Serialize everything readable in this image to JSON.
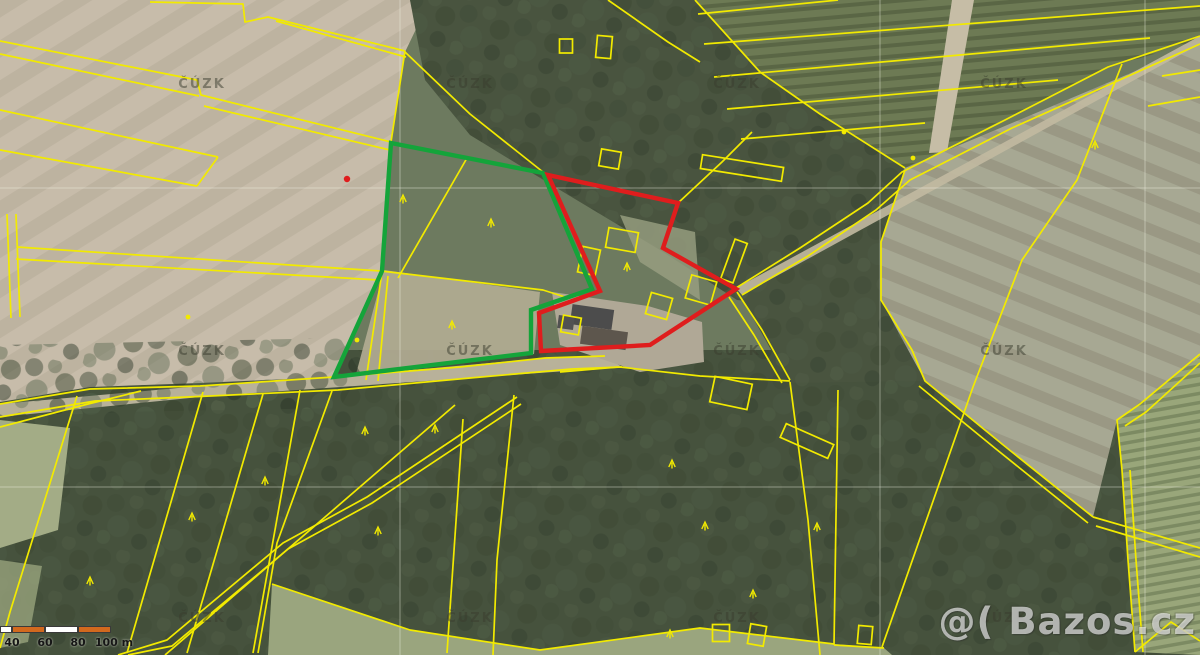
{
  "map": {
    "colors": {
      "parcel_line": "#f2ea00",
      "highlight_green": "#14a43a",
      "highlight_red": "#df1d1d",
      "scale_orange": "#d2691e",
      "scale_white": "#ffffff",
      "grid_line": "rgba(242,242,230,0.42)",
      "watermark_gray": "rgba(58,60,46,0.5)"
    },
    "attribution_watermark": {
      "text": "ČÚZK",
      "positions": [
        [
          202,
          88
        ],
        [
          470,
          88
        ],
        [
          737,
          88
        ],
        [
          1004,
          88
        ],
        [
          202,
          355
        ],
        [
          470,
          355
        ],
        [
          737,
          355
        ],
        [
          1004,
          355
        ],
        [
          202,
          622
        ],
        [
          470,
          622
        ],
        [
          737,
          622
        ],
        [
          1004,
          622
        ]
      ]
    },
    "brand_watermark": {
      "text": "@( Bazos.cz"
    },
    "scale_bar": {
      "unit": "m",
      "segments": [
        {
          "x": 0,
          "w": 12,
          "color": "white"
        },
        {
          "x": 12,
          "w": 33,
          "color": "orange"
        },
        {
          "x": 45,
          "w": 33,
          "color": "white"
        },
        {
          "x": 78,
          "w": 33,
          "color": "orange"
        }
      ],
      "labels": [
        {
          "text": "40",
          "x": 12
        },
        {
          "text": "60",
          "x": 45
        },
        {
          "text": "80",
          "x": 78
        },
        {
          "text": "100 m",
          "x": 114
        }
      ]
    },
    "highlight_green": {
      "points": [
        [
          391,
          143
        ],
        [
          543,
          173
        ],
        [
          592,
          289
        ],
        [
          531,
          310
        ],
        [
          531,
          353
        ],
        [
          334,
          377
        ],
        [
          382,
          271
        ]
      ]
    },
    "highlight_red": {
      "points": [
        [
          548,
          175
        ],
        [
          678,
          203
        ],
        [
          663,
          248
        ],
        [
          736,
          289
        ],
        [
          650,
          345
        ],
        [
          541,
          351
        ],
        [
          539,
          313
        ],
        [
          600,
          291
        ]
      ]
    },
    "red_dot": [
      347,
      179
    ],
    "grid": {
      "vertical_x": [
        400,
        880,
        1145
      ],
      "horizontal_y": [
        188,
        487
      ]
    },
    "parcel_lines": [
      [
        [
          150,
          2
        ],
        [
          243,
          4
        ],
        [
          245,
          22
        ],
        [
          268,
          17
        ],
        [
          405,
          51
        ]
      ],
      [
        [
          276,
          21
        ],
        [
          406,
          57
        ]
      ],
      [
        [
          405,
          51
        ],
        [
          391,
          142
        ]
      ],
      [
        [
          0,
          41
        ],
        [
          197,
          80
        ],
        [
          201,
          95
        ],
        [
          391,
          142
        ]
      ],
      [
        [
          0,
          54
        ],
        [
          199,
          96
        ]
      ],
      [
        [
          204,
          106
        ],
        [
          390,
          150
        ]
      ],
      [
        [
          0,
          110
        ],
        [
          218,
          157
        ]
      ],
      [
        [
          0,
          150
        ],
        [
          197,
          186
        ]
      ],
      [
        [
          218,
          157
        ],
        [
          197,
          186
        ]
      ],
      [
        [
          7,
          214
        ],
        [
          11,
          318
        ]
      ],
      [
        [
          16,
          214
        ],
        [
          20,
          317
        ]
      ],
      [
        [
          17,
          247
        ],
        [
          381,
          271
        ]
      ],
      [
        [
          16,
          259
        ],
        [
          379,
          280
        ]
      ],
      [
        [
          381,
          271
        ],
        [
          543,
          290
        ],
        [
          565,
          297
        ]
      ],
      [
        [
          382,
          272
        ],
        [
          366,
          380
        ]
      ],
      [
        [
          388,
          276
        ],
        [
          378,
          381
        ]
      ],
      [
        [
          0,
          404
        ],
        [
          90,
          389
        ],
        [
          200,
          386
        ],
        [
          334,
          377
        ],
        [
          460,
          367
        ],
        [
          545,
          358
        ],
        [
          605,
          356
        ]
      ],
      [
        [
          0,
          417
        ],
        [
          95,
          401
        ],
        [
          210,
          396
        ],
        [
          338,
          390
        ],
        [
          470,
          378
        ],
        [
          572,
          369
        ],
        [
          622,
          367
        ]
      ],
      [
        [
          0,
          427
        ],
        [
          88,
          404
        ],
        [
          141,
          391
        ]
      ],
      [
        [
          405,
          52
        ],
        [
          470,
          114
        ],
        [
          543,
          172
        ]
      ],
      [
        [
          467,
          158
        ],
        [
          398,
          278
        ]
      ],
      [
        [
          608,
          0
        ],
        [
          668,
          42
        ],
        [
          700,
          62
        ]
      ],
      [
        [
          695,
          0
        ],
        [
          760,
          72
        ],
        [
          820,
          114
        ],
        [
          905,
          168
        ]
      ],
      [
        [
          678,
          203
        ],
        [
          722,
          162
        ],
        [
          752,
          132
        ]
      ],
      [
        [
          663,
          248
        ],
        [
          736,
          289
        ]
      ],
      [
        [
          736,
          288
        ],
        [
          800,
          248
        ],
        [
          868,
          203
        ],
        [
          902,
          172
        ],
        [
          1005,
          120
        ],
        [
          1108,
          67
        ],
        [
          1200,
          36
        ]
      ],
      [
        [
          742,
          295
        ],
        [
          808,
          256
        ],
        [
          876,
          210
        ],
        [
          910,
          180
        ],
        [
          1012,
          128
        ],
        [
          1200,
          44
        ]
      ],
      [
        [
          905,
          170
        ],
        [
          881,
          242
        ],
        [
          881,
          300
        ],
        [
          912,
          350
        ],
        [
          925,
          381
        ],
        [
          1002,
          444
        ],
        [
          1093,
          517
        ]
      ],
      [
        [
          919,
          386
        ],
        [
          996,
          449
        ],
        [
          1088,
          523
        ]
      ],
      [
        [
          1093,
          517
        ],
        [
          1200,
          548
        ]
      ],
      [
        [
          1096,
          526
        ],
        [
          1200,
          557
        ]
      ],
      [
        [
          1122,
          64
        ],
        [
          1077,
          180
        ],
        [
          1022,
          260
        ],
        [
          973,
          387
        ],
        [
          882,
          647
        ]
      ],
      [
        [
          1200,
          354
        ],
        [
          1140,
          404
        ],
        [
          1117,
          420
        ],
        [
          1122,
          470
        ],
        [
          1128,
          560
        ],
        [
          1135,
          652
        ]
      ],
      [
        [
          1200,
          363
        ],
        [
          1146,
          412
        ],
        [
          1125,
          426
        ]
      ],
      [
        [
          1130,
          470
        ],
        [
          1136,
          560
        ],
        [
          1143,
          652
        ]
      ],
      [
        [
          1135,
          652
        ],
        [
          1171,
          622
        ],
        [
          1200,
          641
        ]
      ],
      [
        [
          698,
          14
        ],
        [
          838,
          0
        ]
      ],
      [
        [
          704,
          44
        ],
        [
          1200,
          6
        ]
      ],
      [
        [
          714,
          77
        ],
        [
          1150,
          38
        ]
      ],
      [
        [
          727,
          109
        ],
        [
          1058,
          80
        ]
      ],
      [
        [
          741,
          139
        ],
        [
          925,
          123
        ]
      ],
      [
        [
          1162,
          76
        ],
        [
          1200,
          70
        ]
      ],
      [
        [
          1148,
          106
        ],
        [
          1200,
          97
        ]
      ],
      [
        [
          77,
          396
        ],
        [
          10,
          612
        ],
        [
          0,
          648
        ]
      ],
      [
        [
          203,
          392
        ],
        [
          127,
          653
        ]
      ],
      [
        [
          263,
          394
        ],
        [
          187,
          653
        ]
      ],
      [
        [
          300,
          390
        ],
        [
          253,
          653
        ]
      ],
      [
        [
          332,
          391
        ],
        [
          277,
          543
        ],
        [
          258,
          653
        ]
      ],
      [
        [
          517,
          397
        ],
        [
          367,
          497
        ],
        [
          283,
          543
        ],
        [
          167,
          640
        ],
        [
          118,
          655
        ]
      ],
      [
        [
          521,
          404
        ],
        [
          372,
          503
        ],
        [
          288,
          549
        ],
        [
          172,
          646
        ],
        [
          128,
          655
        ]
      ],
      [
        [
          455,
          405
        ],
        [
          165,
          655
        ]
      ],
      [
        [
          463,
          419
        ],
        [
          447,
          653
        ]
      ],
      [
        [
          514,
          395
        ],
        [
          497,
          560
        ],
        [
          493,
          655
        ]
      ],
      [
        [
          272,
          584
        ],
        [
          410,
          630
        ],
        [
          540,
          650
        ],
        [
          700,
          628
        ],
        [
          834,
          644
        ]
      ],
      [
        [
          790,
          382
        ],
        [
          808,
          520
        ],
        [
          820,
          655
        ]
      ],
      [
        [
          838,
          390
        ],
        [
          834,
          645
        ]
      ],
      [
        [
          834,
          645
        ],
        [
          884,
          648
        ]
      ],
      [
        [
          737,
          292
        ],
        [
          762,
          330
        ],
        [
          790,
          380
        ]
      ],
      [
        [
          729,
          297
        ],
        [
          754,
          335
        ],
        [
          782,
          383
        ]
      ],
      [
        [
          620,
          367
        ],
        [
          700,
          376
        ],
        [
          790,
          381
        ]
      ],
      [
        [
          560,
          372
        ],
        [
          618,
          367
        ]
      ]
    ],
    "parcel_rects": [
      {
        "cx": 622,
        "cy": 240,
        "w": 30,
        "h": 20,
        "r": 10
      },
      {
        "cx": 589,
        "cy": 261,
        "w": 18,
        "h": 26,
        "r": 12
      },
      {
        "cx": 701,
        "cy": 290,
        "w": 26,
        "h": 24,
        "r": 16
      },
      {
        "cx": 659,
        "cy": 306,
        "w": 22,
        "h": 22,
        "r": 16
      },
      {
        "cx": 734,
        "cy": 261,
        "w": 13,
        "h": 42,
        "r": 20
      },
      {
        "cx": 571,
        "cy": 325,
        "w": 18,
        "h": 17,
        "r": 10
      },
      {
        "cx": 742,
        "cy": 168,
        "w": 82,
        "h": 14,
        "r": 9
      },
      {
        "cx": 610,
        "cy": 159,
        "w": 20,
        "h": 17,
        "r": 10
      },
      {
        "cx": 566,
        "cy": 46,
        "w": 13,
        "h": 14,
        "r": 0
      },
      {
        "cx": 604,
        "cy": 47,
        "w": 15,
        "h": 22,
        "r": 5
      },
      {
        "cx": 731,
        "cy": 393,
        "w": 38,
        "h": 26,
        "r": 12
      },
      {
        "cx": 807,
        "cy": 441,
        "w": 52,
        "h": 15,
        "r": 24
      },
      {
        "cx": 757,
        "cy": 635,
        "w": 16,
        "h": 20,
        "r": 10
      },
      {
        "cx": 721,
        "cy": 633,
        "w": 17,
        "h": 17,
        "r": 0
      },
      {
        "cx": 865,
        "cy": 635,
        "w": 14,
        "h": 18,
        "r": 5
      }
    ],
    "tree_symbols": [
      [
        403,
        195
      ],
      [
        491,
        219
      ],
      [
        452,
        321
      ],
      [
        627,
        263
      ],
      [
        365,
        427
      ],
      [
        192,
        513
      ],
      [
        265,
        477
      ],
      [
        90,
        577
      ],
      [
        378,
        527
      ],
      [
        672,
        460
      ],
      [
        705,
        522
      ],
      [
        753,
        590
      ],
      [
        670,
        630
      ],
      [
        817,
        523
      ],
      [
        435,
        425
      ],
      [
        1095,
        141
      ]
    ],
    "point_symbols": [
      [
        844,
        132
      ],
      [
        913,
        158
      ],
      [
        357,
        340
      ],
      [
        188,
        317
      ]
    ]
  }
}
